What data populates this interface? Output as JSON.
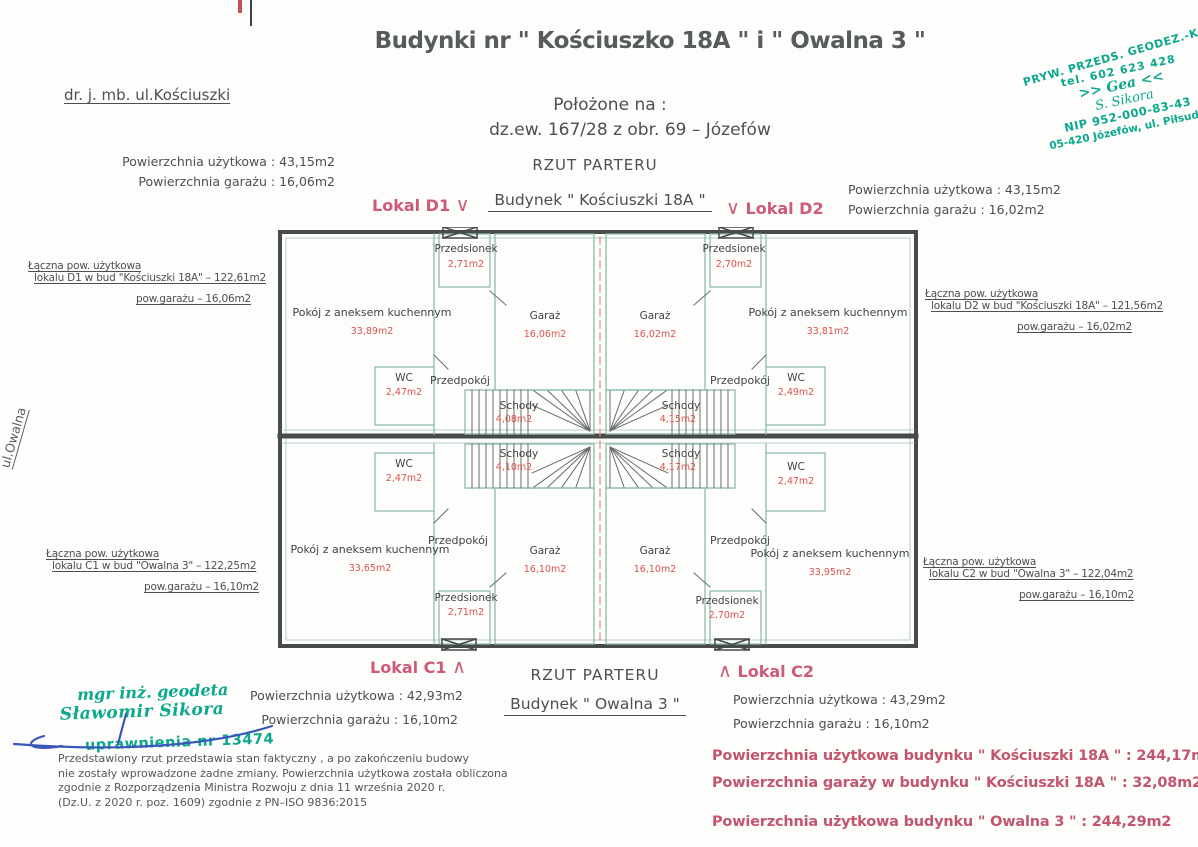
{
  "colors": {
    "ink": "#4b5053",
    "accent_pink": "#cf5a78",
    "area_red": "#d9534f",
    "stamp_green": "#0ba78e",
    "signature_blue": "#3a56b8",
    "wall_dark": "#474b48",
    "partition_teal": "#8fbcae"
  },
  "header": {
    "ref": "dr. j. mb.   ul.Kościuszki",
    "title": "Budynki nr \" Kościuszko 18A \" i \" Owalna 3 \"",
    "located1": "Położone na :",
    "located2": "dz.ew.  167/28   z obr.  69   –    Józefów",
    "rzut": "RZUT PARTERU"
  },
  "stamp_top": {
    "l1": "PRYW. PRZEDS. GEODEZ.-KA",
    "l2": "tel. 602 623 428",
    "l3": ">> Gea <<",
    "l4": "S. Sikora",
    "l5": "NIP 952-000-83-43",
    "l6": "05-420 Józefów, ul. Piłsudsk"
  },
  "top_building": {
    "lokal_d1": "Lokal D1",
    "v_mark": "∨",
    "name": "Budynek   \" Kościuszki 18A \"",
    "lokal_d2": "Lokal D2",
    "d1_area_uzytkowa": "Powierzchnia użytkowa  : 43,15m2",
    "d1_area_garaz": "Powierzchnia garażu : 16,06m2",
    "d2_area_uzytkowa": "Powierzchnia użytkowa  : 43,15m2",
    "d2_area_garaz": "Powierzchnia garażu : 16,02m2"
  },
  "bottom_building": {
    "lokal_c1": "Lokal C1",
    "caret_mark": "∧",
    "rzut": "RZUT PARTERU",
    "name": "Budynek   \" Owalna 3 \"",
    "lokal_c2": "Lokal C2",
    "c1_area_uzytkowa": "Powierzchnia użytkowa : 42,93m2",
    "c1_area_garaz": "Powierzchnia garażu : 16,10m2",
    "c2_area_uzytkowa": "Powierzchnia użytkowa : 43,29m2",
    "c2_area_garaz": "Powierzchnia garażu : 16,10m2"
  },
  "side_labels": {
    "d1": {
      "l1": "Łączna pow. użytkowa",
      "l2": "lokalu D1 w bud \"Kościuszki 18A\" – 122,61m2",
      "l3": "pow.garażu – 16,06m2"
    },
    "d2": {
      "l1": "Łączna pow. użytkowa",
      "l2": "lokalu D2 w bud \"Kościuszki 18A\" – 121,56m2",
      "l3": "pow.garażu – 16,02m2"
    },
    "c1": {
      "l1": "Łączna pow. użytkowa",
      "l2": "lokalu C1 w bud \"Owalna 3\" – 122,25m2",
      "l3": "pow.garażu – 16,10m2"
    },
    "c2": {
      "l1": "Łączna pow. użytkowa",
      "l2": "lokalu C2 w bud \"Owalna 3\" – 122,04m2",
      "l3": "pow.garażu – 16,10m2"
    },
    "street_left": "ul.Owalna"
  },
  "plan": {
    "units": {
      "d1": {
        "pokoj": "Pokój z aneksem kuchennym",
        "pokoj_a": "33,89m2",
        "przedsionek": "Przedsionek",
        "przedsionek_a": "2,71m2",
        "garaz": "Garaż",
        "garaz_a": "16,06m2",
        "przedpokoj": "Przedpokój",
        "wc": "WC",
        "wc_a": "2,47m2",
        "schody": "Schody",
        "schody_a": "4,08m2"
      },
      "d2": {
        "pokoj": "Pokój z aneksem kuchennym",
        "pokoj_a": "33,81m2",
        "przedsionek": "Przedsionek",
        "przedsionek_a": "2,70m2",
        "garaz": "Garaż",
        "garaz_a": "16,02m2",
        "przedpokoj": "Przedpokój",
        "wc": "WC",
        "wc_a": "2,49m2",
        "schody": "Schody",
        "schody_a": "4,15m2"
      },
      "c1": {
        "pokoj": "Pokój z aneksem kuchennym",
        "pokoj_a": "33,65m2",
        "przedsionek": "Przedsionek",
        "przedsionek_a": "2,71m2",
        "garaz": "Garaż",
        "garaz_a": "16,10m2",
        "przedpokoj": "Przedpokój",
        "wc": "WC",
        "wc_a": "2,47m2",
        "schody": "Schody",
        "schody_a": "4,10m2"
      },
      "c2": {
        "pokoj": "Pokój z aneksem kuchennym",
        "pokoj_a": "33,95m2",
        "przedsionek": "Przedsionek",
        "przedsionek_a": "2,70m2",
        "garaz": "Garaż",
        "garaz_a": "16,10m2",
        "przedpokoj": "Przedpokój",
        "wc": "WC",
        "wc_a": "2,47m2",
        "schody": "Schody",
        "schody_a": "4,17m2"
      }
    }
  },
  "stamp_bottom": {
    "l1": "mgr inż. geodeta",
    "l2": "Sławomir Sikora",
    "l3": "uprawnienia nr 13474"
  },
  "footnote": {
    "l1": "Przedstawiony rzut przedstawia stan faktyczny , a po zakończeniu budowy",
    "l2": "nie zostały wprowadzone żadne zmiany. Powierzchnia użytkowa została obliczona",
    "l3": "zgodnie z Rozporządzenia Ministra Rozwoju z dnia 11 września 2020 r.",
    "l4": "(Dz.U. z 2020 r. poz. 1609) zgodnie z PN–ISO 9836:2015"
  },
  "summary": {
    "l1": "Powierzchnia użytkowa budynku \" Kościuszki 18A \" : 244,17m2",
    "l2": "Powierzchnia garaży w budynku \" Kościuszki 18A \" : 32,08m2",
    "l3": "Powierzchnia użytkowa budynku \" Owalna 3 \" : 244,29m2"
  }
}
